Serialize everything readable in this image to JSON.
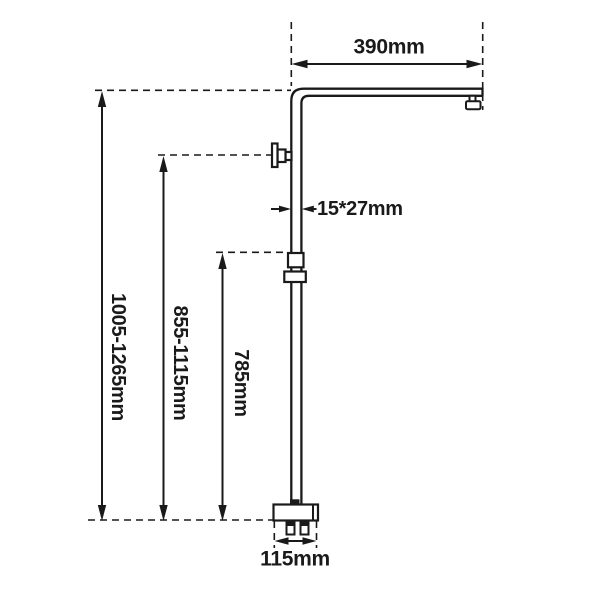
{
  "diagram": {
    "type": "technical-dimension-drawing",
    "subject": "square shower rail riser column with top arm, hand-shower holder, slider bracket and base valve body",
    "colors": {
      "line": "#1a1a1a",
      "background": "#ffffff"
    },
    "labels": {
      "arm_width": "390mm",
      "pipe_section": "15*27mm",
      "overall_height": "1005-1265mm",
      "holder_height": "855-1115mm",
      "slider_height": "785mm",
      "base_width": "115mm"
    }
  }
}
